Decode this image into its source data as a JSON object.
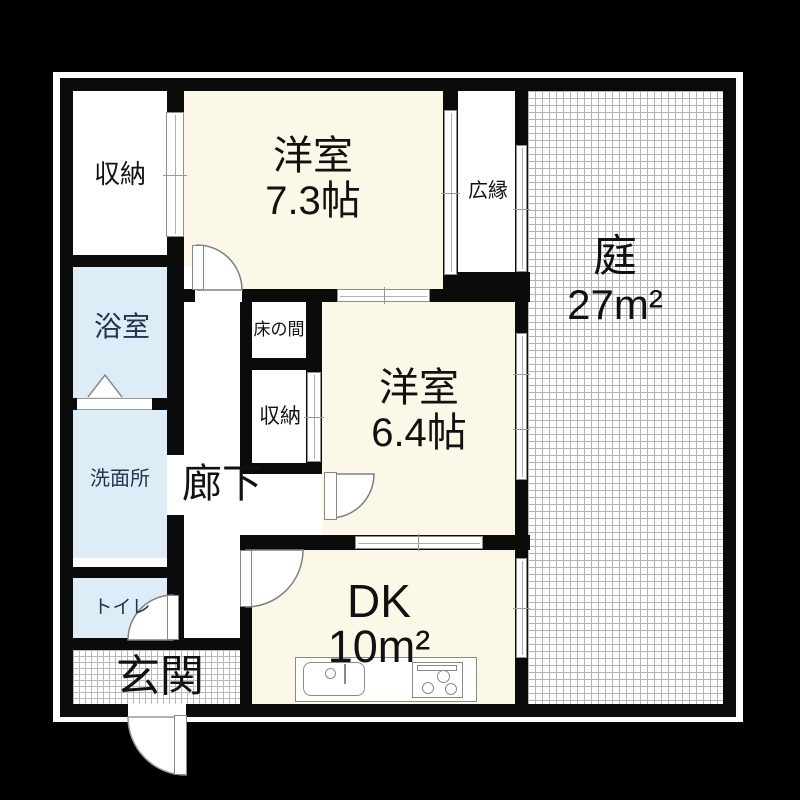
{
  "floorplan": {
    "rooms": {
      "closet_top": {
        "label": "収納"
      },
      "western_room_7_3": {
        "label": "洋室",
        "size": "7.3帖"
      },
      "veranda": {
        "label": "広縁"
      },
      "garden": {
        "label": "庭",
        "size": "27m²"
      },
      "bathroom": {
        "label": "浴室"
      },
      "tokonoma": {
        "label": "床の間"
      },
      "closet_mid": {
        "label": "収納"
      },
      "western_room_6_4": {
        "label": "洋室",
        "size": "6.4帖"
      },
      "washroom": {
        "label": "洗面所"
      },
      "hallway": {
        "label": "廊下"
      },
      "toilet": {
        "label": "トイレ"
      },
      "entrance": {
        "label": "玄関"
      },
      "dining_kitchen": {
        "label": "DK",
        "size": "10m²"
      }
    },
    "colors": {
      "outside_background": "#000000",
      "wall": "#0b0b0b",
      "tatami_room_fill": "#fcf8e7",
      "wet_room_fill": "#dcedf8",
      "hatch_line": "#b3b3b3",
      "text": "#111111"
    },
    "symbols": {
      "door_swing": "quarter-arc-door",
      "sliding_window": "double-line-window",
      "folding_door": "triangle-fold-door",
      "kitchen_sink": "sink-with-faucet-icon",
      "stove": "three-burner-stove-icon"
    }
  }
}
